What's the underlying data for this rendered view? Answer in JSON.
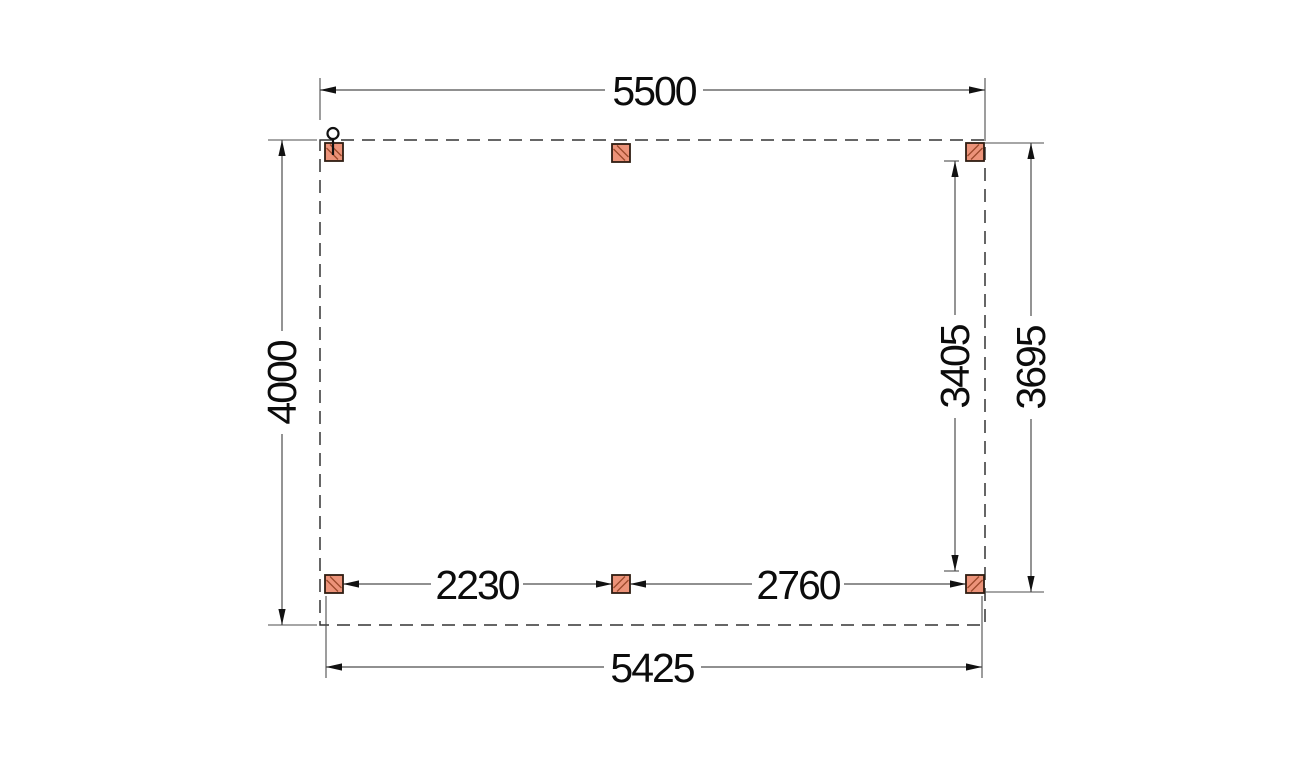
{
  "drawing": {
    "type": "construction-plan-top-view",
    "dimensions": {
      "top_width": "5500",
      "left_height": "4000",
      "right_inner_height": "3405",
      "right_outer_height": "3695",
      "bottom_left_bay": "2230",
      "bottom_right_bay": "2760",
      "bottom_width": "5425"
    },
    "colors": {
      "background": "#ffffff",
      "outline_dash": "#333333",
      "dimension_line": "#4d4d4d",
      "arrow": "#111111",
      "label_text": "#0c0c0c",
      "post_fill": "#ec9379",
      "post_stroke": "#2f1d12",
      "post_hatch": "#9c4a2b"
    }
  }
}
